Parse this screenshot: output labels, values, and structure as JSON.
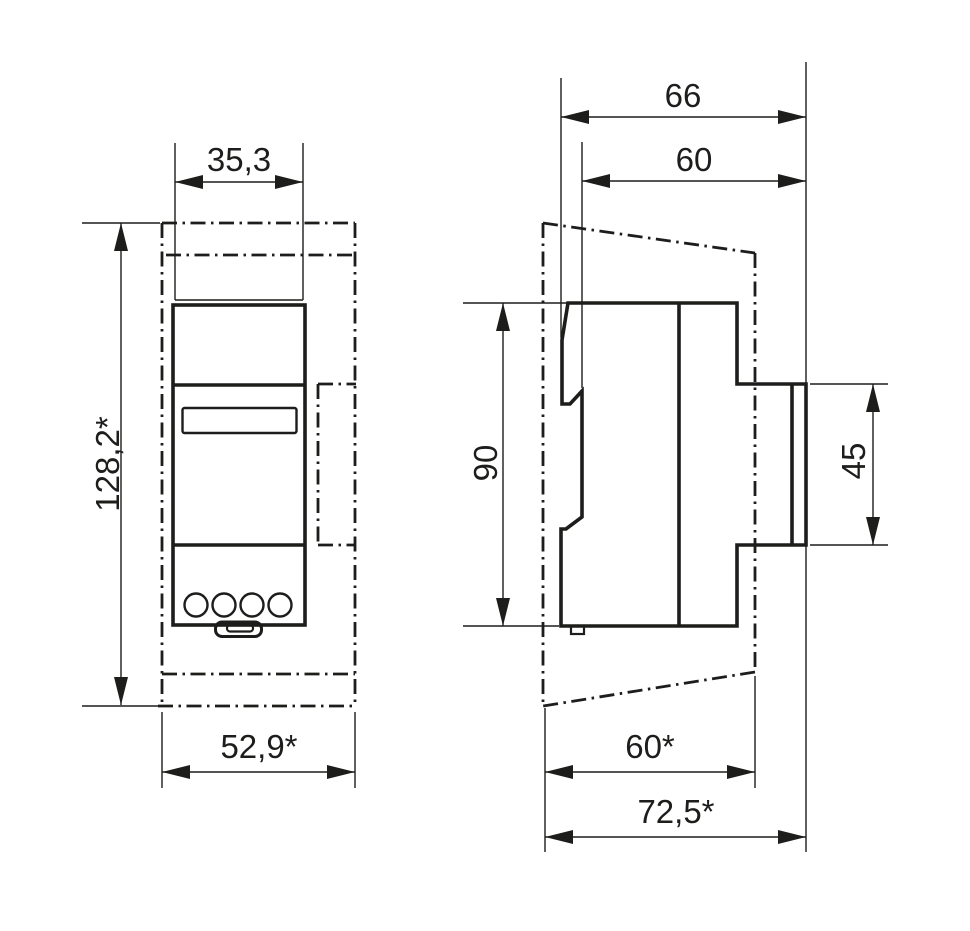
{
  "drawing": {
    "front_view": {
      "width": "35,3",
      "height": "128,2*",
      "total_width": "52,9*"
    },
    "side_view": {
      "total_depth": "66",
      "device_depth": "60",
      "device_height": "90",
      "rear_section_height": "45",
      "lower_depth": "60*",
      "lower_total_depth": "72,5*"
    },
    "colors": {
      "line": "#1d1d1b",
      "background": "#ffffff"
    }
  }
}
